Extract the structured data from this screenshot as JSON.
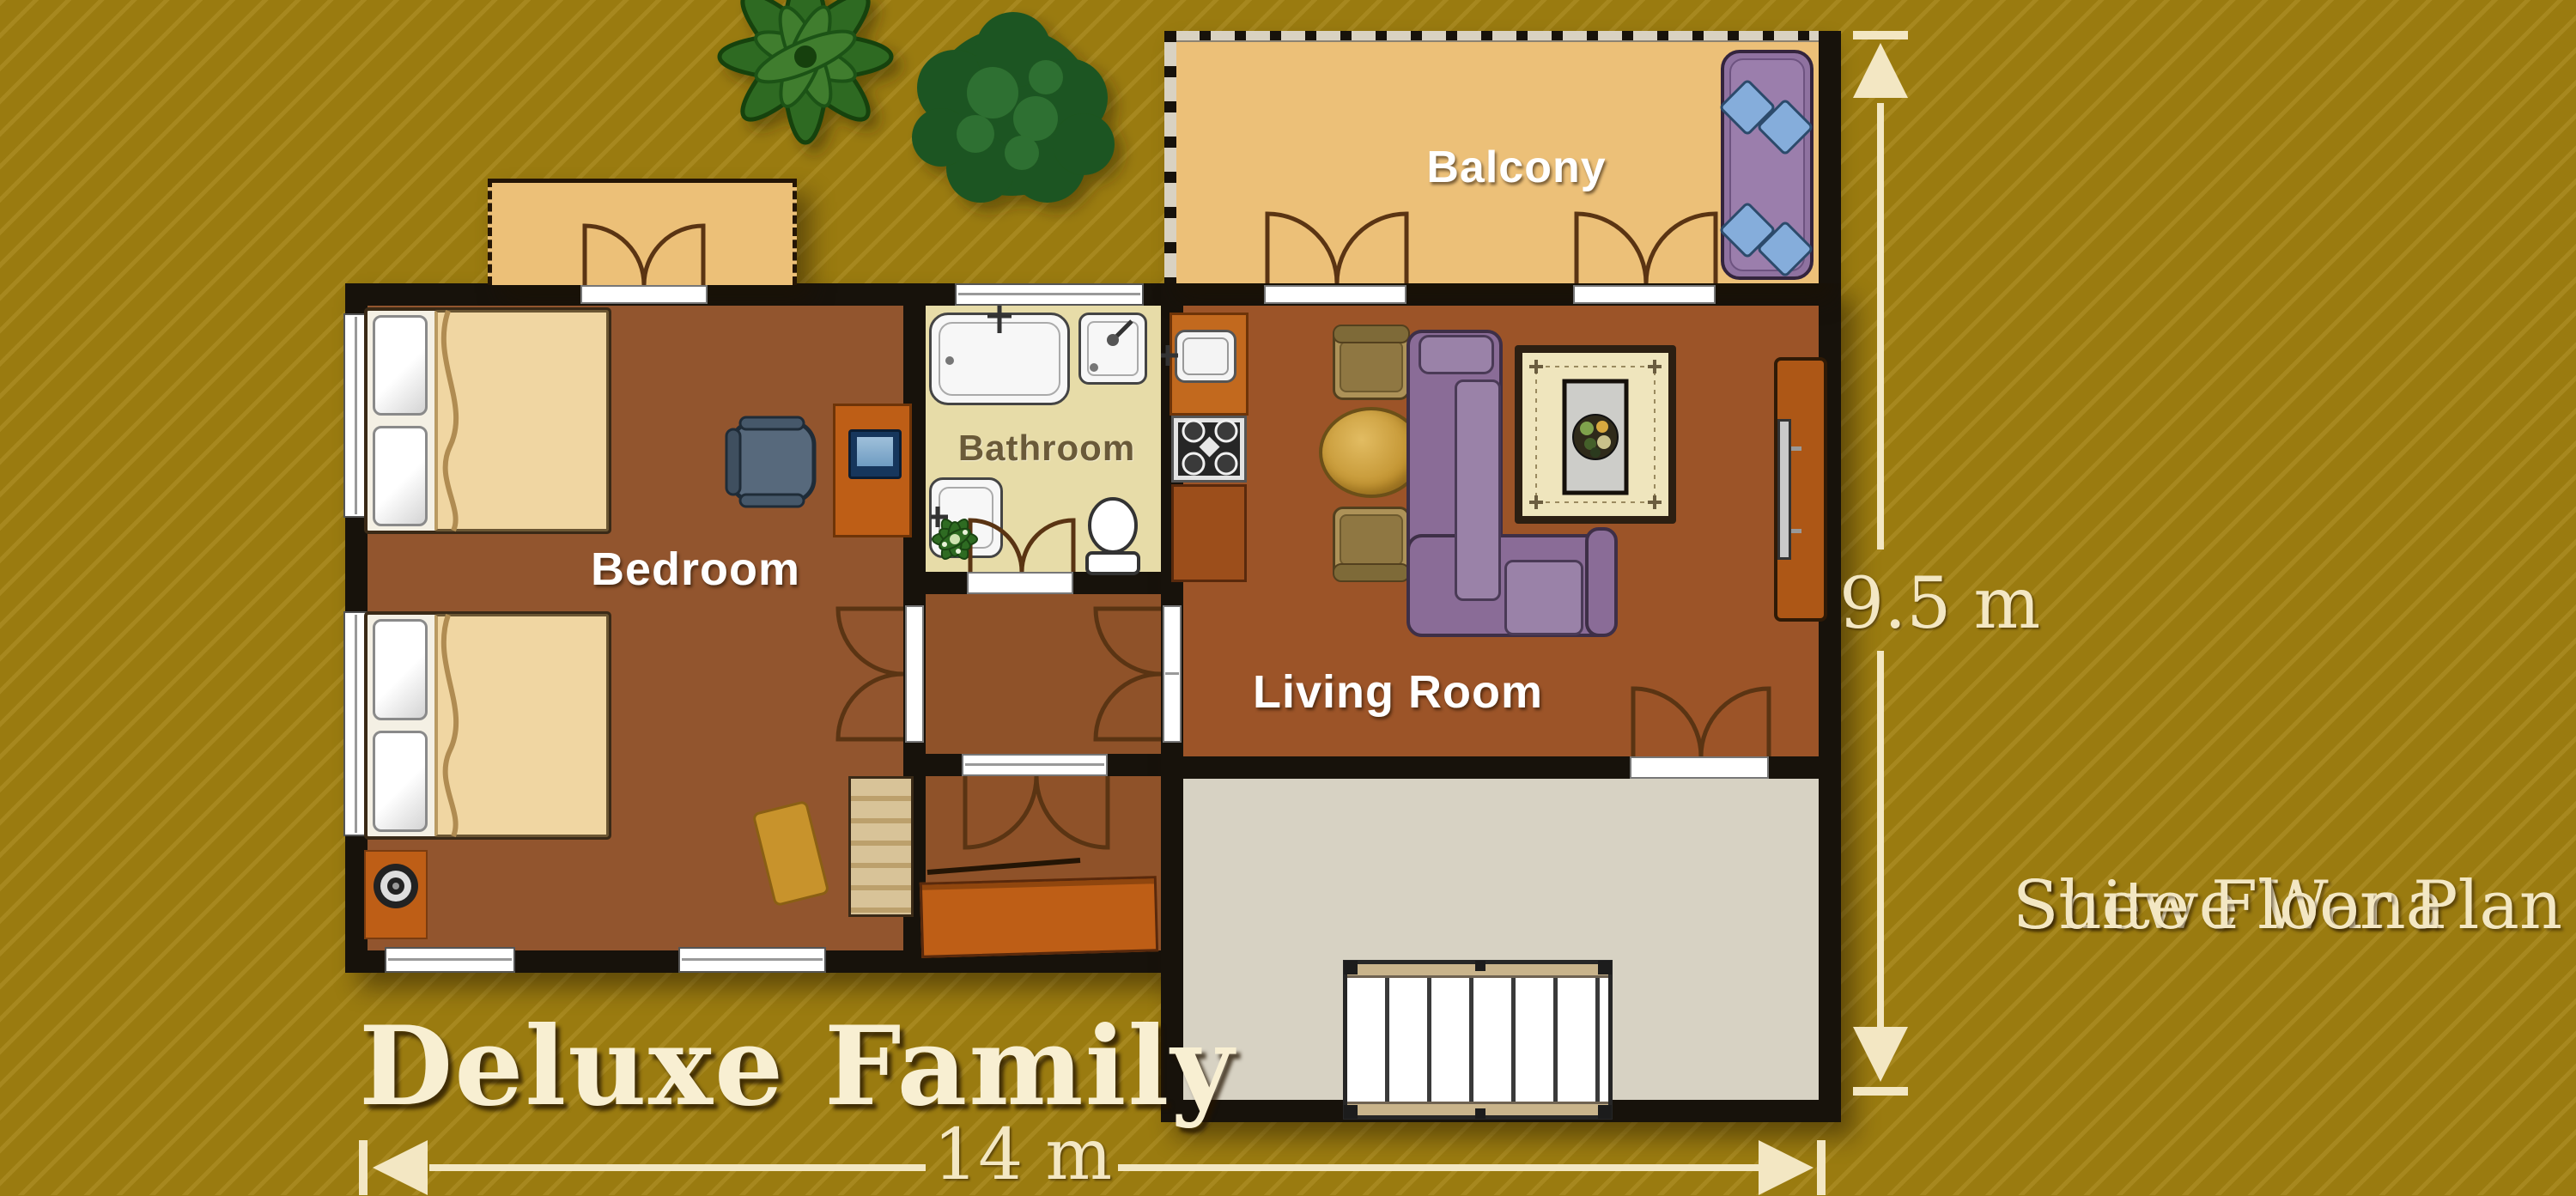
{
  "labels": {
    "balcony": "Balcony",
    "bedroom": "Bedroom",
    "bathroom": "Bathroom",
    "living_room": "Living Room"
  },
  "caption": {
    "text": "Deluxe Family"
  },
  "side_title": {
    "line1": "Shewe Wana",
    "line2": "Suite Floor Plan"
  },
  "dimensions": {
    "width": "14 m",
    "height": "9.5 m"
  },
  "palette": {
    "bg": "#9A7B10",
    "wall": "#17120B",
    "bedroom_floor": "#92552E",
    "living_floor": "#9C5428",
    "hall_floor": "#8F5229",
    "bathroom_floor": "#E7DCA8",
    "balcony_floor": "#ECC078",
    "terrace_floor": "#D7D2C3",
    "counter": "#C2691E",
    "cabinet": "#9C4E1B",
    "orange": "#BE5E16",
    "sofa": "#8A6C97",
    "sofa_light": "#9A82A8",
    "cushion_blue": "#85ADDB",
    "lounger": "#8F72A0",
    "table_gold": "#C89838",
    "chair_tan": "#AD9258",
    "rug_cream": "#EFE5BD",
    "rug_gold": "#C8932C",
    "bench": "#D8C398",
    "text_cream": "#F3E7C3",
    "label_white": "#FFFFFF",
    "bathroom_label": "#6A5A39",
    "stairs_rail": "#C9B48B",
    "blanket": "#F0D6A2"
  },
  "icons": {
    "plant-icon": "leaf rosette svg",
    "tree-icon": "foliage blob svg",
    "bed-icon": "pillows+blanket",
    "office-chair-icon": "svg",
    "laptop-icon": "css rect",
    "speaker-icon": "concentric circles",
    "bench-icon": "striped rect",
    "rug-icon": "bordered rect",
    "bathtub-icon": "rounded rect",
    "shower-icon": "rounded rect",
    "sink-icon": "rounded rect",
    "toilet-icon": "ellipse+tank",
    "stove-icon": "4 burners + diamond",
    "dining-table-icon": "gold ellipse",
    "sofa-icon": "L sectional",
    "tv-icon": "slim bar",
    "lounger-icon": "rounded rect + diamond cushions",
    "stairs-icon": "treads",
    "door-swing-icon": "quarter-arc pair",
    "dimension-arrow-icon": "triangle+bar"
  }
}
